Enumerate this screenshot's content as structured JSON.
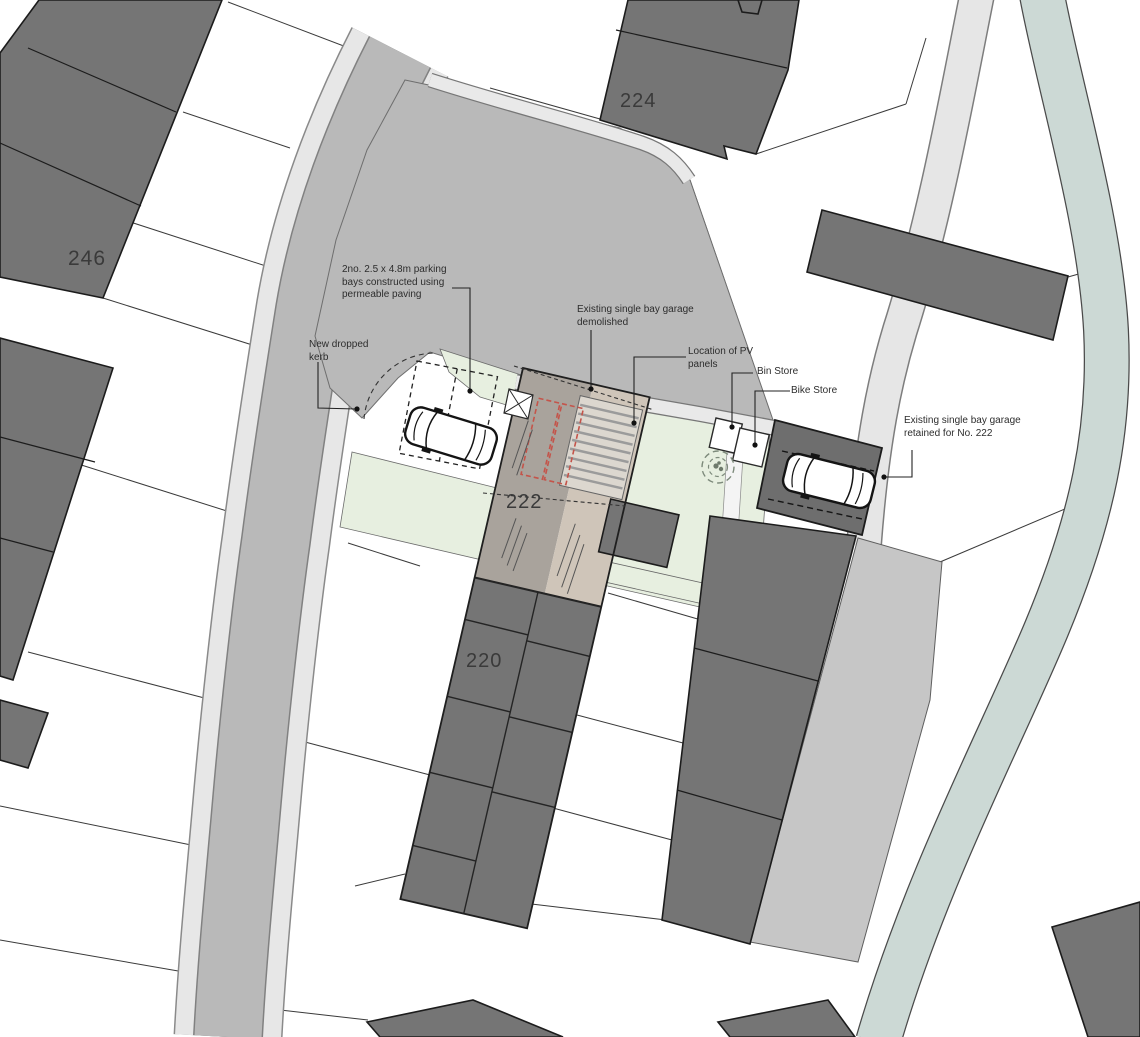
{
  "drawing": {
    "title": "Proposed site plan",
    "annotations": {
      "parking_bays": "2no. 2.5 x 4.8m parking\nbays constructed using\npermeable paving",
      "dropped_kerb": "New dropped\nkerb",
      "garage_demolished": "Existing single bay garage\ndemolished",
      "pv_panels": "Location of PV\npanels",
      "bin_store": "Bin Store",
      "bike_store": "Bike Store",
      "garage_retained": "Existing single bay garage\nretained for No. 222"
    },
    "houses": {
      "246": "246",
      "224": "224",
      "222": "222",
      "220": "220"
    },
    "colors": {
      "building_dark": "#757575",
      "road": "#b9b9b9",
      "pavement": "#e7e7e7",
      "yard": "#c6c6c6",
      "stream": "#ccd9d5",
      "garden_green": "#e7efe0",
      "roof_grey": "#a9a39c",
      "roof_tan": "#cfc5b9",
      "pv_panel": "#dcd7cf",
      "demolition_red": "#c4544a",
      "outline": "#1c1c1c"
    }
  }
}
